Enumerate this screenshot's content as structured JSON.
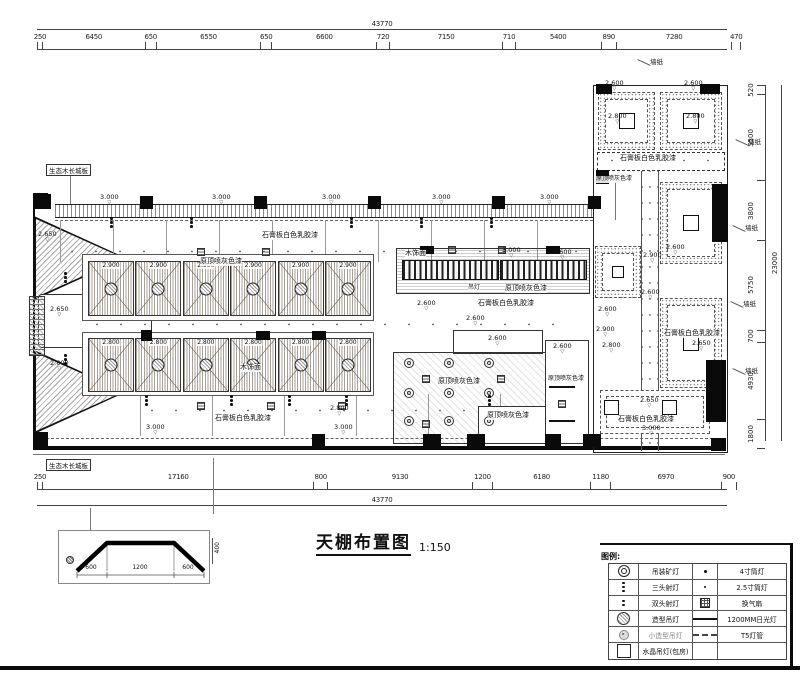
{
  "title": {
    "text": "天棚布置图",
    "scale": "1:150"
  },
  "dimensions": {
    "top": {
      "total": "43770",
      "segments": [
        "250",
        "6450",
        "650",
        "6550",
        "650",
        "6600",
        "720",
        "7150",
        "710",
        "5400",
        "890",
        "7280",
        "470"
      ]
    },
    "bottom": {
      "total": "43770",
      "segments": [
        "250",
        "17160",
        "800",
        "9130",
        "1200",
        "6180",
        "1180",
        "6970",
        "900"
      ]
    },
    "right": {
      "total": "23000",
      "segments": [
        "520",
        "5500",
        "3800",
        "5750",
        "700",
        "4930",
        "1800"
      ]
    }
  },
  "plan": {
    "wallpaper_text": "墙纸",
    "wallpaper_labels": [
      {
        "x": 650,
        "y": 56
      },
      {
        "x": 748,
        "y": 136
      },
      {
        "x": 745,
        "y": 222
      },
      {
        "x": 743,
        "y": 298
      },
      {
        "x": 745,
        "y": 365
      }
    ],
    "boxed_labels": [
      {
        "x": 46,
        "y": 164,
        "t": "生态木长城板"
      },
      {
        "x": 46,
        "y": 459,
        "t": "生态木长城板"
      }
    ],
    "materials": [
      {
        "x": 262,
        "y": 232,
        "t": "石膏板白色乳胶漆"
      },
      {
        "x": 200,
        "y": 258,
        "t": "原顶喷灰色漆"
      },
      {
        "x": 240,
        "y": 364,
        "t": "木饰面"
      },
      {
        "x": 215,
        "y": 415,
        "t": "石膏板白色乳胶漆"
      },
      {
        "x": 405,
        "y": 250,
        "t": "木饰面"
      },
      {
        "x": 468,
        "y": 285,
        "t": "吊灯",
        "s": 1
      },
      {
        "x": 505,
        "y": 285,
        "t": "原顶喷灰色漆"
      },
      {
        "x": 478,
        "y": 300,
        "t": "石膏板白色乳胶漆"
      },
      {
        "x": 438,
        "y": 378,
        "t": "原顶喷灰色漆"
      },
      {
        "x": 487,
        "y": 412,
        "t": "原顶喷灰色漆"
      },
      {
        "x": 548,
        "y": 376,
        "t": "原顶喷灰色漆",
        "s": 1
      },
      {
        "x": 620,
        "y": 155,
        "t": "石膏板白色乳胶漆"
      },
      {
        "x": 596,
        "y": 176,
        "t": "原顶喷灰色漆",
        "s": 1
      },
      {
        "x": 664,
        "y": 330,
        "t": "石膏板白色乳胶漆"
      },
      {
        "x": 618,
        "y": 416,
        "t": "石膏板白色乳胶漆"
      }
    ],
    "coffer_rows": [
      {
        "elevation": "2.900"
      },
      {
        "elevation": "2.800"
      }
    ],
    "elevations": [
      {
        "x": 100,
        "y": 194,
        "t": "3.000"
      },
      {
        "x": 212,
        "y": 194,
        "t": "3.000"
      },
      {
        "x": 322,
        "y": 194,
        "t": "3.000"
      },
      {
        "x": 432,
        "y": 194,
        "t": "3.000"
      },
      {
        "x": 540,
        "y": 194,
        "t": "3.000"
      },
      {
        "x": 38,
        "y": 231,
        "t": "2.650"
      },
      {
        "x": 50,
        "y": 306,
        "t": "2.650"
      },
      {
        "x": 50,
        "y": 360,
        "t": "2.800"
      },
      {
        "x": 502,
        "y": 247,
        "t": "3.000"
      },
      {
        "x": 553,
        "y": 249,
        "t": "2.600"
      },
      {
        "x": 417,
        "y": 300,
        "t": "2.600"
      },
      {
        "x": 466,
        "y": 315,
        "t": "2.600"
      },
      {
        "x": 488,
        "y": 335,
        "t": "2.600"
      },
      {
        "x": 553,
        "y": 343,
        "t": "2.600"
      },
      {
        "x": 146,
        "y": 424,
        "t": "3.000"
      },
      {
        "x": 334,
        "y": 424,
        "t": "3.000"
      },
      {
        "x": 330,
        "y": 405,
        "t": "2.800"
      },
      {
        "x": 605,
        "y": 80,
        "t": "2.600"
      },
      {
        "x": 684,
        "y": 80,
        "t": "2.600"
      },
      {
        "x": 608,
        "y": 113,
        "t": "2.800"
      },
      {
        "x": 686,
        "y": 113,
        "t": "2.800"
      },
      {
        "x": 666,
        "y": 244,
        "t": "2.600"
      },
      {
        "x": 643,
        "y": 252,
        "t": "2.900"
      },
      {
        "x": 641,
        "y": 289,
        "t": "2.600"
      },
      {
        "x": 598,
        "y": 306,
        "t": "2.600"
      },
      {
        "x": 596,
        "y": 326,
        "t": "2.900"
      },
      {
        "x": 602,
        "y": 342,
        "t": "2.800"
      },
      {
        "x": 692,
        "y": 340,
        "t": "2.650"
      },
      {
        "x": 640,
        "y": 397,
        "t": "2.650"
      },
      {
        "x": 642,
        "y": 425,
        "t": "3.000"
      }
    ],
    "columns": [
      [
        37,
        194,
        14,
        15
      ],
      [
        140,
        196,
        13,
        13
      ],
      [
        254,
        196,
        13,
        13
      ],
      [
        368,
        196,
        13,
        13
      ],
      [
        492,
        196,
        13,
        13
      ],
      [
        588,
        196,
        13,
        13
      ],
      [
        33,
        193,
        15,
        16
      ],
      [
        33,
        432,
        15,
        15
      ],
      [
        312,
        434,
        13,
        13
      ],
      [
        423,
        434,
        18,
        13
      ],
      [
        467,
        434,
        18,
        13
      ],
      [
        545,
        434,
        16,
        13
      ],
      [
        583,
        434,
        18,
        13
      ],
      [
        596,
        84,
        16,
        10
      ],
      [
        700,
        84,
        20,
        10
      ],
      [
        712,
        184,
        16,
        58
      ],
      [
        706,
        360,
        20,
        62
      ],
      [
        596,
        170,
        13,
        14
      ],
      [
        711,
        438,
        15,
        13
      ],
      [
        141,
        330,
        11,
        11
      ],
      [
        256,
        331,
        14,
        9
      ],
      [
        312,
        331,
        14,
        9
      ],
      [
        420,
        246,
        14,
        8
      ],
      [
        546,
        246,
        14,
        8
      ]
    ],
    "symbols": {
      "rings": [
        [
          404,
          358
        ],
        [
          444,
          358
        ],
        [
          484,
          358
        ],
        [
          404,
          388
        ],
        [
          444,
          388
        ],
        [
          484,
          388
        ],
        [
          404,
          416
        ],
        [
          444,
          416
        ],
        [
          484,
          416
        ]
      ],
      "fans": [
        [
          422,
          375
        ],
        [
          497,
          375
        ],
        [
          422,
          420
        ],
        [
          197,
          248
        ],
        [
          262,
          248
        ],
        [
          448,
          246
        ],
        [
          498,
          246
        ],
        [
          197,
          402
        ],
        [
          267,
          402
        ],
        [
          338,
          402
        ],
        [
          558,
          400
        ]
      ],
      "threedots": [
        [
          110,
          221
        ],
        [
          190,
          221
        ],
        [
          350,
          221
        ],
        [
          420,
          221
        ],
        [
          490,
          221
        ],
        [
          145,
          399
        ],
        [
          230,
          399
        ],
        [
          288,
          399
        ],
        [
          345,
          399
        ],
        [
          488,
          399
        ],
        [
          64,
          276
        ],
        [
          64,
          358
        ]
      ],
      "crystals": [
        [
          604,
          400
        ],
        [
          662,
          400
        ]
      ],
      "fluors": [
        [
          549,
          386
        ],
        [
          549,
          420
        ]
      ]
    }
  },
  "detail": {
    "widths": [
      "600",
      "1200",
      "600"
    ],
    "height_label": "400"
  },
  "legend": {
    "title": "图例:",
    "rows": [
      {
        "icon1": "ring",
        "name1": "吊装矿灯",
        "icon2": "dot4",
        "name2": "4寸筒灯"
      },
      {
        "icon1": "threedot",
        "name1": "三头射灯",
        "icon2": "dot25",
        "name2": "2.5寸筒灯"
      },
      {
        "icon1": "twodot",
        "name1": "双头射灯",
        "icon2": "exh",
        "name2": "换气扇"
      },
      {
        "icon1": "shaped",
        "name1": "造型吊灯",
        "icon2": "fluor",
        "name2": "1200MM日光灯"
      },
      {
        "icon1": "smshaped",
        "name1": "小造型吊灯",
        "icon2": "t5",
        "name2": "T5灯管"
      },
      {
        "icon1": "crystal",
        "name1": "水晶吊灯(包房)",
        "icon2": "none",
        "name2": ""
      }
    ]
  }
}
